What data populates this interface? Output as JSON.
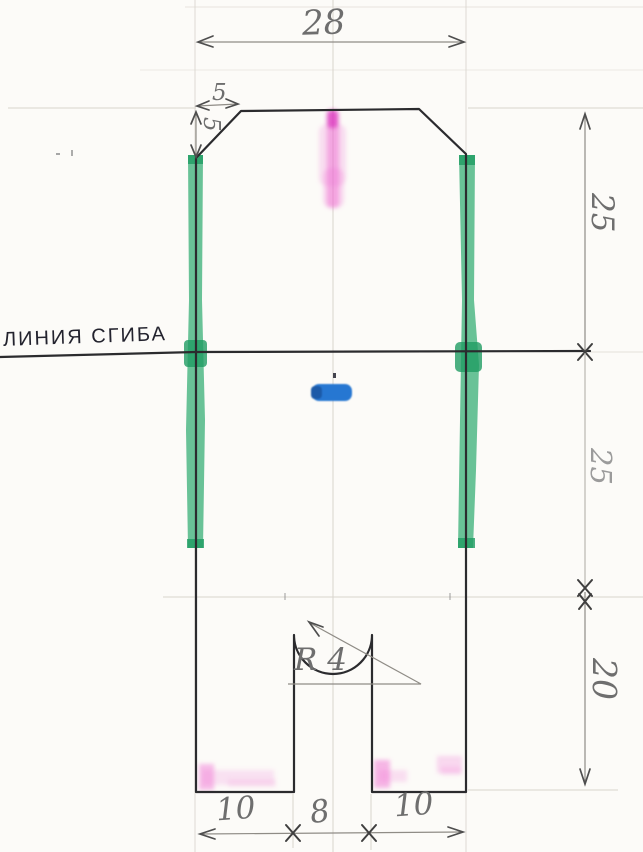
{
  "drawing": {
    "fold_line_label": "ЛИНИЯ СГИБА",
    "dims": {
      "top_width": "28",
      "chamfer_width": "5",
      "chamfer_height": "5",
      "upper_section_height": "25",
      "lower_section_height": "25",
      "leg_section_height": "20",
      "left_leg_width": "10",
      "slot_width": "8",
      "right_leg_width": "10",
      "slot_radius": "R 4"
    }
  },
  "colors": {
    "paper": "#fcfbf8",
    "ink": "#2b2b2e",
    "pencil": "#6e6e6e",
    "pencil-light": "#9b9b9b",
    "faint": "#d8d4cd",
    "green": "#3fb27b",
    "green-dark": "#1f9c63",
    "pink": "#ef6fd2",
    "pink-dark": "#d92fbc",
    "blue": "#2677d2",
    "blue-dark": "#1a5aa8"
  }
}
